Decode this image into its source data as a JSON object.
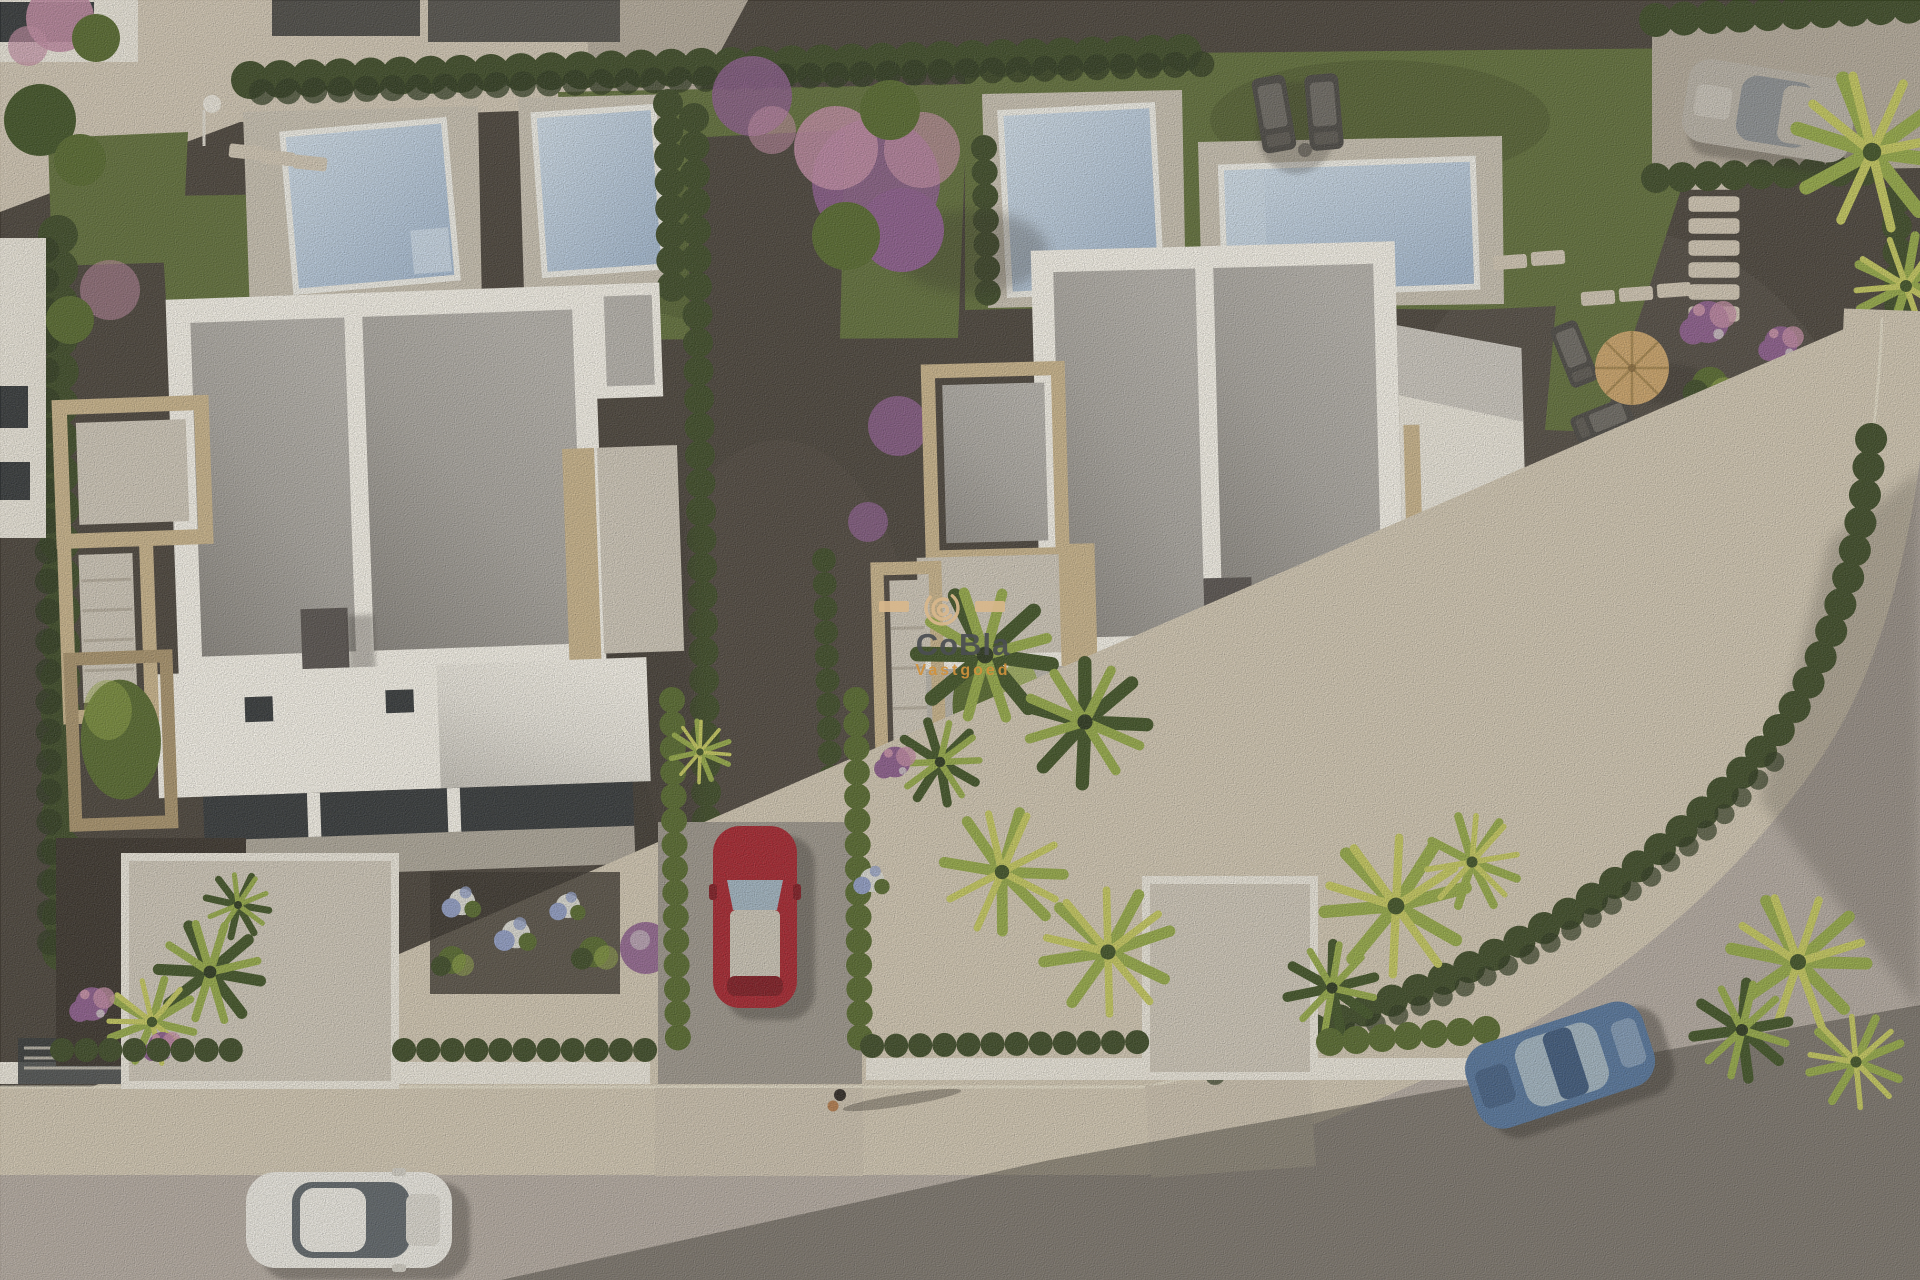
{
  "scene": {
    "type": "aerial-3d-architectural-render",
    "description": "Aerial 3D rendering of a residential development: two modern white flat-roof villas with gravel roof decks, four private swimming pools, landscaped gardens with palms and purple flowering shrubs, a curved street with sidewalk, parked cars and a pedestrian",
    "watermark": {
      "title": "CoBla",
      "subtitle": "Vastgoed"
    },
    "inventory": {
      "villas": 2,
      "pools": 4,
      "cars": [
        "red sedan in driveway",
        "white sedan on street",
        "blue coupe on street",
        "silver suv in rear lane"
      ],
      "pedestrians": 1,
      "sun_loungers": 2,
      "parasols": 1
    }
  },
  "palette": {
    "base_gravel": "#49433c",
    "gravel_light": "#5a544b",
    "paving": "#cfc5b4",
    "paving_shadow": "#b2a99b",
    "grass": "#5f6e3b",
    "grass_dark": "#46532d",
    "hedge": "#3c4a28",
    "hedge_dark": "#2c3820",
    "foliage": "#55682f",
    "palm_dark": "#3f5227",
    "palm_bright": "#93a848",
    "palm_yellow": "#c2c65e",
    "pool_water": "#a3b8d0",
    "pool_water_light": "#cddbe8",
    "pool_deck": "#c6bfb1",
    "pool_rim": "#edece6",
    "roof_white": "#f2efe7",
    "roof_panel": "#b4b1ac",
    "stone_tan": "#c7b28b",
    "stone_tan_dark": "#a6916c",
    "chimney": "#575250",
    "glass_dark": "#34383b",
    "wall_white": "#e8e4da",
    "terrace": "#ccc5b8",
    "road": "#b2a9a1",
    "sidewalk": "#cfc5b2",
    "curb": "#e6dfcd",
    "soil": "#3a342e",
    "flower_purple": "#8a5c8c",
    "flower_pink": "#c08ba4",
    "flower_blue": "#8f9cc4",
    "flower_white": "#d8d8d2",
    "straw": "#c9a26a",
    "car_red": "#a3242f",
    "car_red_dark": "#7e1b24",
    "car_white": "#e9e7e1",
    "car_blue": "#54749c",
    "car_blue_dark": "#3d587c",
    "car_silver": "#b7b1a7",
    "car_glass": "#9fb2c0",
    "shadow": "#2e2a26",
    "wm_title": "#4b4e52",
    "wm_accent": "#d2923c",
    "wm_logo": "#d9b88c"
  }
}
